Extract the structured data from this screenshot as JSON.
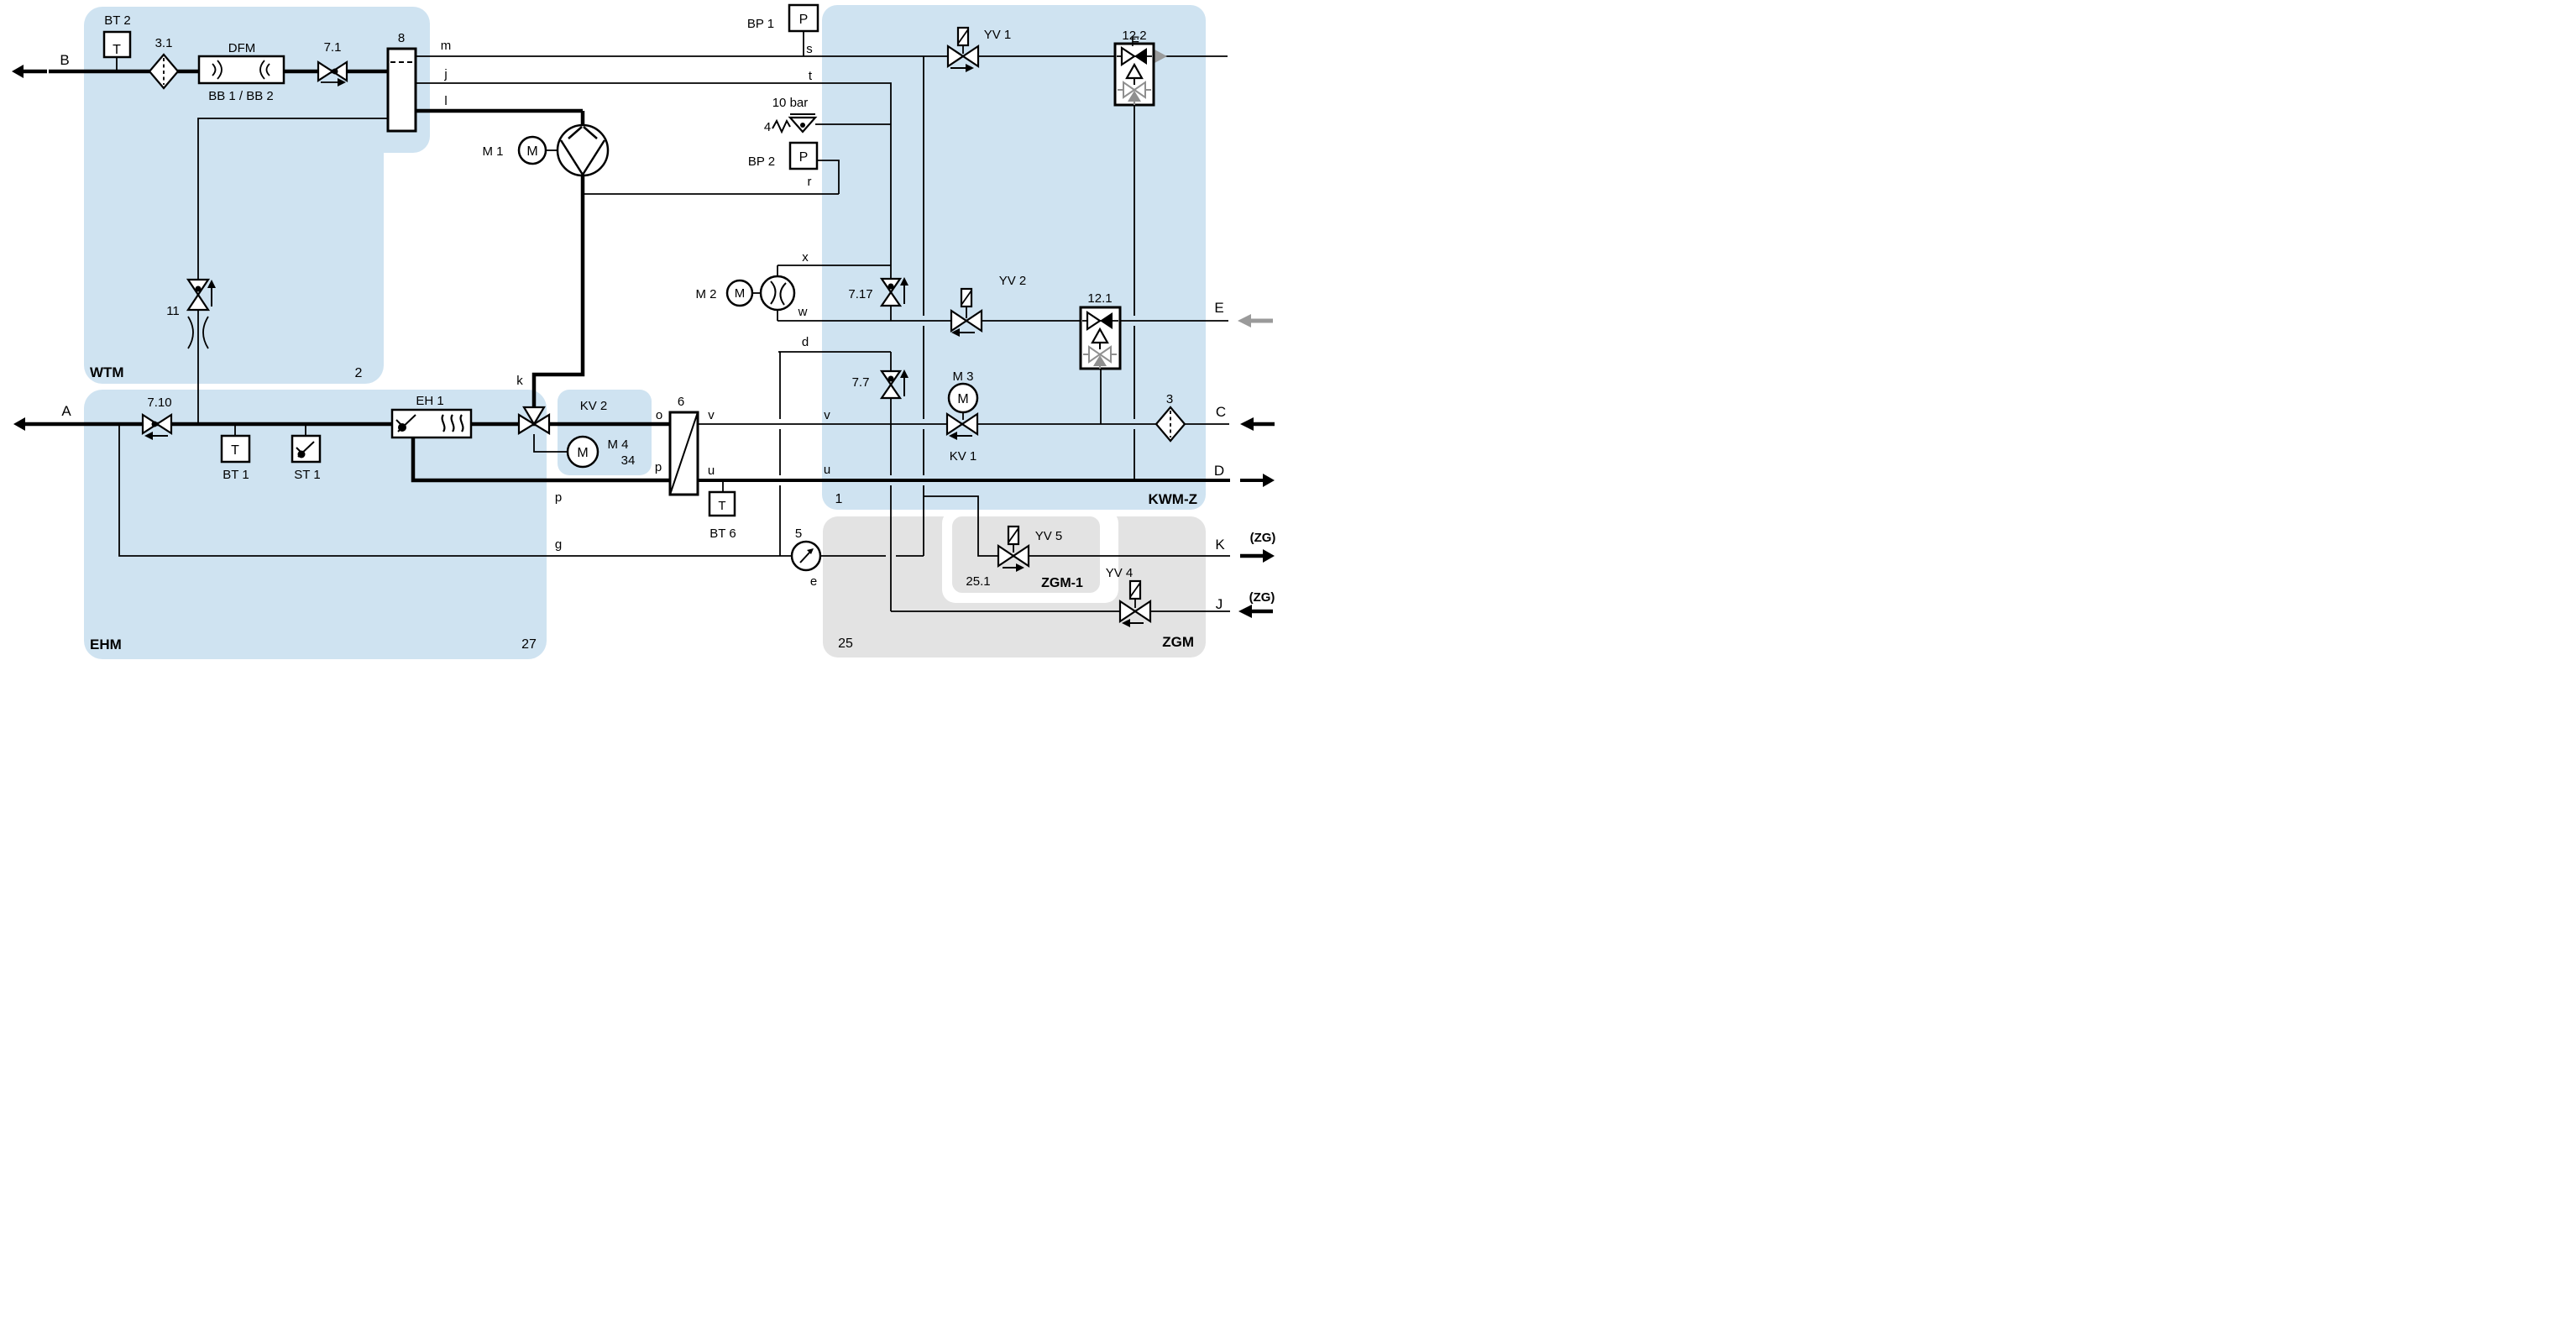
{
  "modules": {
    "wtm": {
      "name": "WTM",
      "number": "2"
    },
    "ehm": {
      "name": "EHM",
      "number": "27"
    },
    "kwmz": {
      "name": "KWM-Z",
      "number": "1"
    },
    "zgm": {
      "name": "ZGM",
      "number": "25"
    },
    "zgm1": {
      "name": "ZGM-1",
      "number": "25.1"
    }
  },
  "ports": {
    "b": "B",
    "a": "A",
    "f": "F",
    "e": "E",
    "c": "C",
    "d": "D",
    "k": "K",
    "j": "J",
    "zg": "(ZG)"
  },
  "letters": {
    "m": "m",
    "j": "j",
    "l": "l",
    "s": "s",
    "t": "t",
    "r": "r",
    "x": "x",
    "w": "w",
    "d": "d",
    "k": "k",
    "o": "o",
    "p": "p",
    "v": "v",
    "u": "u",
    "g": "g",
    "e": "e"
  },
  "components": {
    "bt2": "BT 2",
    "bt1": "BT 1",
    "bt6": "BT 6",
    "st1": "ST 1",
    "bp1": "BP 1",
    "bp2": "BP 2",
    "m1": "M 1",
    "m2": "M 2",
    "m3": "M 3",
    "m4": "M 4",
    "yv1": "YV 1",
    "yv2": "YV 2",
    "yv4": "YV 4",
    "yv5": "YV 5",
    "kv1": "KV 1",
    "kv2": "KV 2",
    "valve_71": "7.1",
    "valve_710": "7.10",
    "valve_717": "7.17",
    "valve_77": "7.7",
    "valve_11": "11",
    "filter_31": "3.1",
    "filter_3": "3",
    "dfm": "DFM",
    "dfm_sensors": "BB 1 / BB 2",
    "tank": "8",
    "heat_exchanger": "6",
    "heater": "EH 1",
    "relief_valve": "4",
    "relief_pressure": "10 bar",
    "gauge": "5",
    "kv2_drive": "34",
    "temp_glyph": "T",
    "pressure_glyph": "P",
    "motor_glyph": "M"
  },
  "colors": {
    "module_blue": "#cfe3f1",
    "module_gray": "#e3e3e3",
    "line": "#000000",
    "gray_flow": "#9a9a9a"
  }
}
